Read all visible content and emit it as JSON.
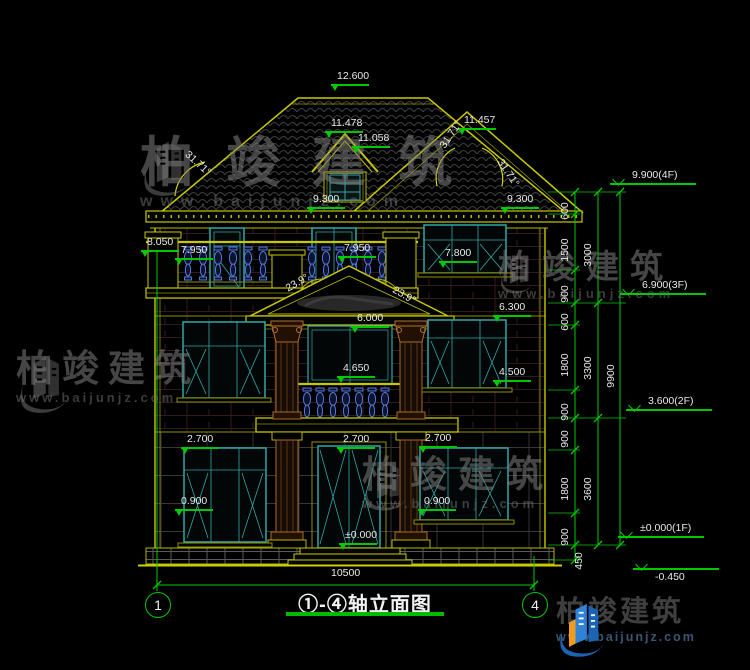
{
  "drawing": {
    "title": "①-④轴立面图",
    "axis_left": "1",
    "axis_right": "4"
  },
  "watermark": {
    "brand": "柏竣建筑",
    "url": "www.baijunjz.com"
  },
  "colors": {
    "line_yellow": "#c8c800",
    "dim_green": "#00c800",
    "text_white": "#e9e9e9",
    "window_teal": "#2fa8a8",
    "baluster_blue": "#5577dd",
    "column_brown": "#a86a28",
    "logo_blue": "#1a63b5",
    "logo_orange": "#f29b1d"
  },
  "annotations": [
    {
      "t": "12.600",
      "x": 337,
      "y": 71,
      "m": "tri"
    },
    {
      "t": "11.478",
      "x": 331,
      "y": 118,
      "m": "tri"
    },
    {
      "t": "11.058",
      "x": 358,
      "y": 133,
      "m": "tri"
    },
    {
      "t": "11.457",
      "x": 464,
      "y": 115,
      "m": "tri"
    },
    {
      "t": "31.71°",
      "x": 186,
      "y": 148,
      "r": 42
    },
    {
      "t": "31.71°",
      "x": 443,
      "y": 142,
      "r": -56
    },
    {
      "t": "31.71°",
      "x": 499,
      "y": 155,
      "r": 56
    },
    {
      "t": "9.300",
      "x": 313,
      "y": 194,
      "m": "tri"
    },
    {
      "t": "9.300",
      "x": 507,
      "y": 194,
      "m": "tri"
    },
    {
      "t": "8.050",
      "x": 147,
      "y": 237,
      "m": "tri"
    },
    {
      "t": "7.950",
      "x": 181,
      "y": 245,
      "m": "tri"
    },
    {
      "t": "7.950",
      "x": 344,
      "y": 243,
      "m": "tri"
    },
    {
      "t": "7.800",
      "x": 445,
      "y": 248,
      "m": "tri"
    },
    {
      "t": "23.9°",
      "x": 287,
      "y": 284,
      "r": -30
    },
    {
      "t": "23.9°",
      "x": 393,
      "y": 284,
      "r": 30
    },
    {
      "t": "6.000",
      "x": 357,
      "y": 313,
      "m": "tri"
    },
    {
      "t": "6.300",
      "x": 499,
      "y": 302,
      "m": "tri"
    },
    {
      "t": "4.650",
      "x": 343,
      "y": 363,
      "m": "tri"
    },
    {
      "t": "4.500",
      "x": 499,
      "y": 367,
      "m": "tri"
    },
    {
      "t": "2.700",
      "x": 187,
      "y": 434,
      "m": "tri"
    },
    {
      "t": "2.700",
      "x": 343,
      "y": 434,
      "m": "tri"
    },
    {
      "t": "2.700",
      "x": 425,
      "y": 433,
      "m": "tri"
    },
    {
      "t": "0.900",
      "x": 181,
      "y": 496,
      "m": "tri"
    },
    {
      "t": "0.900",
      "x": 424,
      "y": 496,
      "m": "tri"
    },
    {
      "t": "±0.000",
      "x": 345,
      "y": 530,
      "m": "tri"
    },
    {
      "t": "10500",
      "x": 331,
      "y": 568
    },
    {
      "t": "600",
      "x": 566,
      "y": 214,
      "r": -90
    },
    {
      "t": "1500",
      "x": 566,
      "y": 256,
      "r": -90
    },
    {
      "t": "900",
      "x": 566,
      "y": 297,
      "r": -90
    },
    {
      "t": "600",
      "x": 566,
      "y": 325,
      "r": -90
    },
    {
      "t": "1800",
      "x": 566,
      "y": 371,
      "r": -90
    },
    {
      "t": "900",
      "x": 566,
      "y": 415,
      "r": -90
    },
    {
      "t": "900",
      "x": 566,
      "y": 442,
      "r": -90
    },
    {
      "t": "1800",
      "x": 566,
      "y": 495,
      "r": -90
    },
    {
      "t": "900",
      "x": 566,
      "y": 540,
      "r": -90
    },
    {
      "t": "450",
      "x": 580,
      "y": 564,
      "r": -90
    },
    {
      "t": "3000",
      "x": 589,
      "y": 261,
      "r": -90
    },
    {
      "t": "3300",
      "x": 589,
      "y": 374,
      "r": -90
    },
    {
      "t": "3600",
      "x": 589,
      "y": 495,
      "r": -90
    },
    {
      "t": "9900",
      "x": 612,
      "y": 382,
      "r": -90
    },
    {
      "t": "9.900(4F)",
      "x": 632,
      "y": 170,
      "m": "lvl",
      "n": "level-marker-4f"
    },
    {
      "t": "6.900(3F)",
      "x": 642,
      "y": 280,
      "m": "lvl",
      "n": "level-marker-3f"
    },
    {
      "t": "3.600(2F)",
      "x": 648,
      "y": 396,
      "m": "lvl",
      "n": "level-marker-2f"
    },
    {
      "t": "±0.000(1F)",
      "x": 640,
      "y": 523,
      "m": "lvl",
      "n": "level-marker-1f"
    },
    {
      "t": "-0.450",
      "x": 655,
      "y": 572,
      "m": "lvlup",
      "n": "level-marker-base"
    }
  ]
}
